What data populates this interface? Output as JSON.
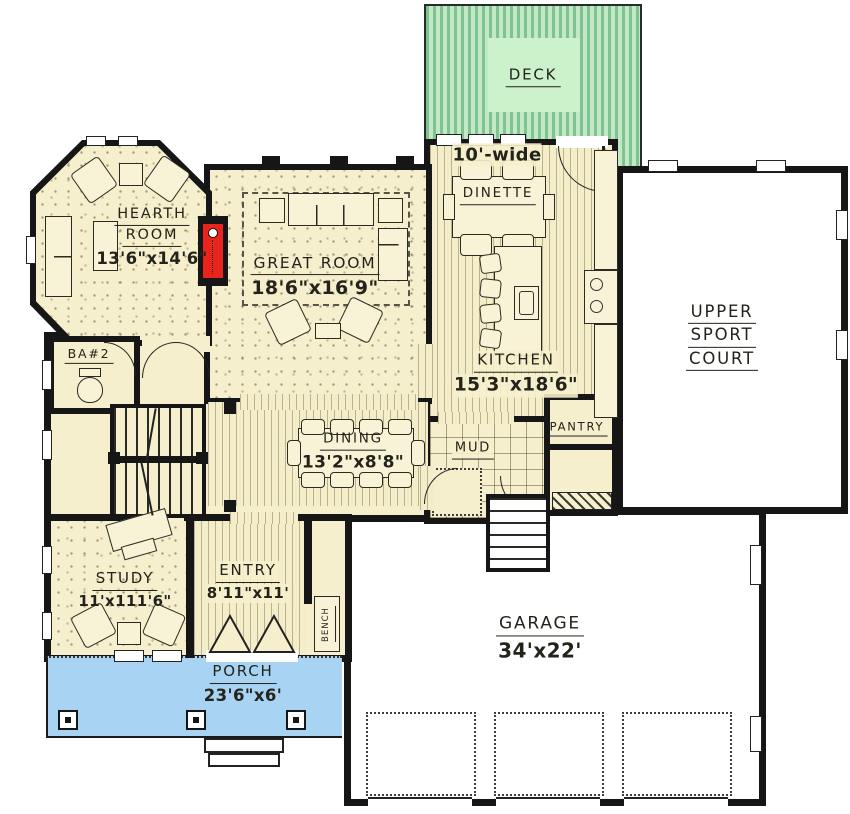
{
  "rooms": {
    "deck": {
      "lines": [
        "DECK"
      ]
    },
    "dinette": {
      "note": "10'-wide",
      "lines": [
        "DINETTE"
      ]
    },
    "hearth": {
      "lines": [
        "HEARTH",
        "ROOM"
      ],
      "dims": "13'6\"x14'6\""
    },
    "great": {
      "lines": [
        "GREAT ROOM"
      ],
      "dims": "18'6\"x16'9\""
    },
    "sport": {
      "lines": [
        "UPPER",
        "SPORT",
        "COURT"
      ]
    },
    "kitchen": {
      "lines": [
        "KITCHEN"
      ],
      "dims": "15'3\"x18'6\""
    },
    "pantry": {
      "lines": [
        "PANTRY"
      ]
    },
    "mud": {
      "lines": [
        "MUD"
      ]
    },
    "dining": {
      "lines": [
        "DINING"
      ],
      "dims": "13'2\"x8'8\""
    },
    "bath2": {
      "lines": [
        "BA#2"
      ]
    },
    "study": {
      "lines": [
        "STUDY"
      ],
      "dims": "11'x111'6\""
    },
    "entry": {
      "lines": [
        "ENTRY"
      ],
      "dims": "8'11\"x11'"
    },
    "bench": {
      "lines": [
        "BENCH"
      ]
    },
    "porch": {
      "lines": [
        "PORCH"
      ],
      "dims": "23'6\"x6'"
    },
    "garage": {
      "lines": [
        "GARAGE"
      ],
      "dims": "34'x22'"
    }
  },
  "colors": {
    "wall": "#161616",
    "floor_cream": "#f6efcd",
    "deck_green_dark": "#7fc48e",
    "deck_green_light": "#c2e8c8",
    "deck_label_bg": "#cbf2cb",
    "porch_blue": "#a8d3f3",
    "fireplace_red": "#e8241c",
    "exterior_white": "#ffffff"
  }
}
